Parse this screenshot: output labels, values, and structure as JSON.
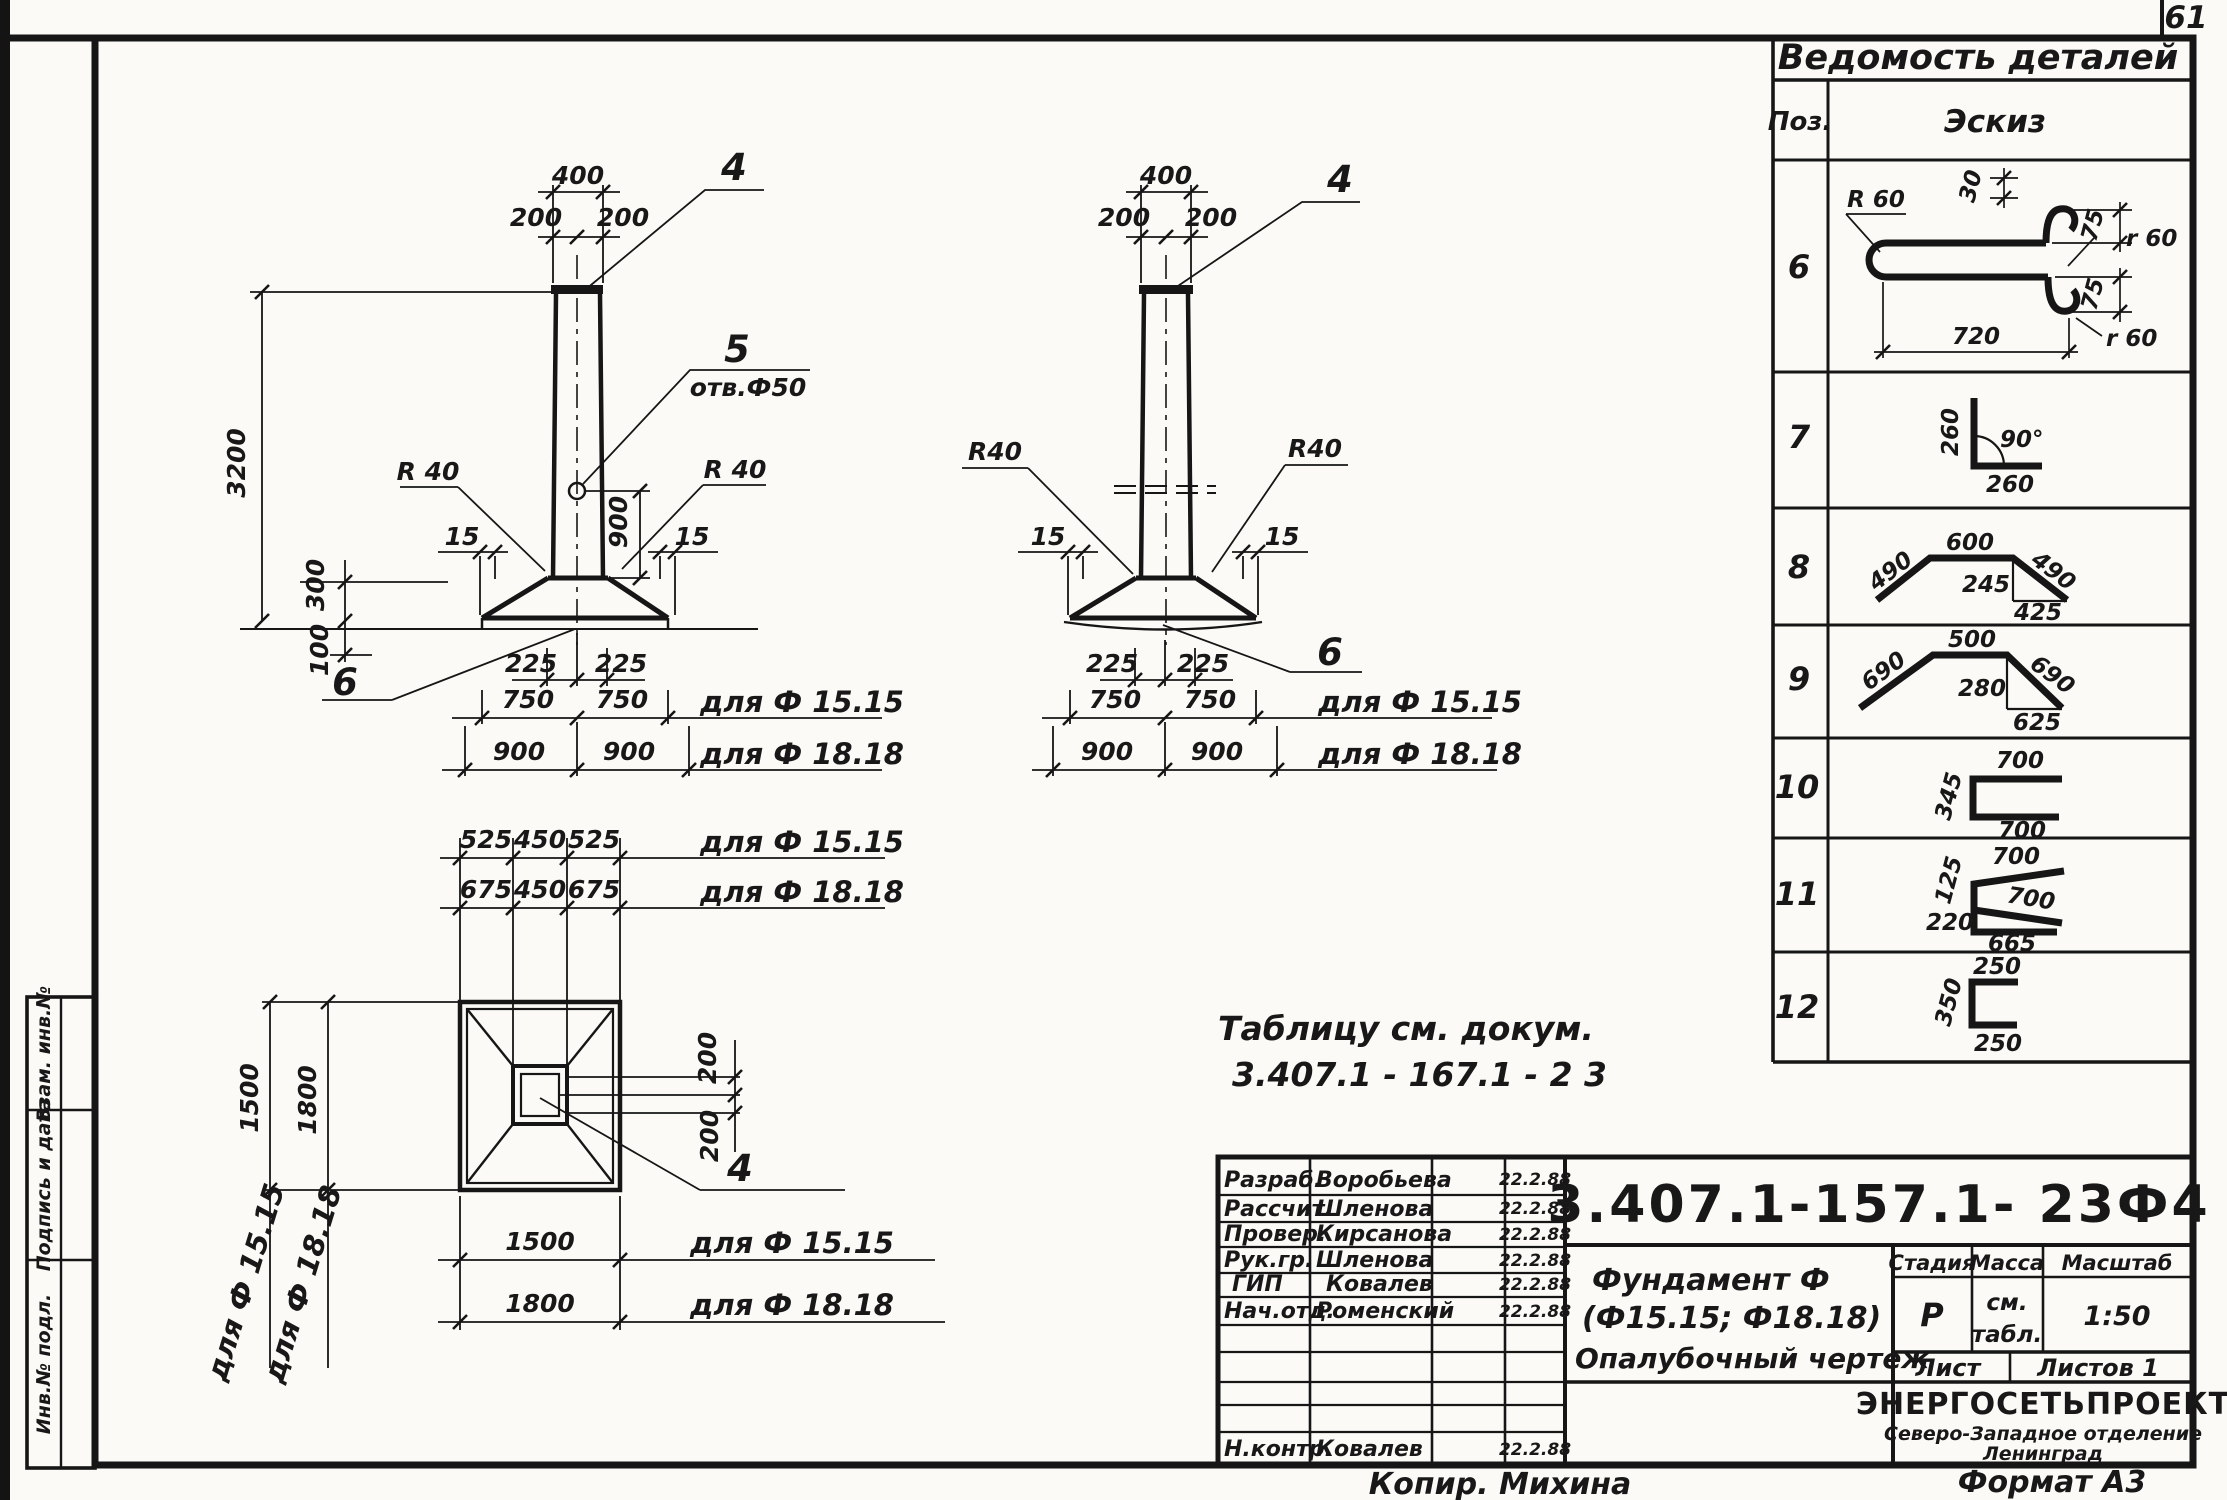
{
  "page_number": "61",
  "frame_stamps": {
    "top": "Взам. инв.№",
    "middle": "Подпись и дата",
    "bottom": "Инв.№ подл."
  },
  "views": {
    "front": {
      "dim_top_width": "400",
      "dim_top_left": "200",
      "dim_top_right": "200",
      "callout_top": "4",
      "callout_hole": "5",
      "hole_label": "отв.Ф50",
      "dim_height": "3200",
      "radius_left": "R 40",
      "radius_right": "R 40",
      "dim_off_left": "15",
      "dim_off_right": "15",
      "dim_300": "300",
      "dim_100": "100",
      "dim_900": "900",
      "dim_225_left": "225",
      "dim_225_right": "225",
      "callout_base": "6",
      "row_f15": {
        "a": "750",
        "b": "750",
        "label": "для Ф 15.15"
      },
      "row_f18": {
        "a": "900",
        "b": "900",
        "label": "для Ф 18.18"
      }
    },
    "side": {
      "dim_top_width": "400",
      "dim_top_left": "200",
      "dim_top_right": "200",
      "callout_top": "4",
      "radius_left": "R40",
      "radius_right": "R40",
      "dim_off_left": "15",
      "dim_off_right": "15",
      "dim_225_left": "225",
      "dim_225_right": "225",
      "callout_base": "6",
      "row_f15": {
        "a": "750",
        "b": "750",
        "label": "для Ф 15.15"
      },
      "row_f18": {
        "a": "900",
        "b": "900",
        "label": "для Ф 18.18"
      }
    },
    "plan": {
      "row_f15": {
        "a": "525",
        "b": "450",
        "c": "525",
        "label": "для Ф 15.15"
      },
      "row_f18": {
        "a": "675",
        "b": "450",
        "c": "675",
        "label": "для Ф 18.18"
      },
      "dim_1500": "1500",
      "dim_1800": "1800",
      "rot_label_f15": "для Ф 15.15",
      "rot_label_f18": "для Ф 18.18",
      "dim_200_top": "200",
      "dim_200_bottom": "200",
      "callout": "4",
      "bottom_f15": {
        "value": "1500",
        "label": "для Ф 15.15"
      },
      "bottom_f18": {
        "value": "1800",
        "label": "для Ф 18.18"
      }
    }
  },
  "note": {
    "line1": "Таблицу см. докум.",
    "line2": "3.407.1 - 167.1 -  2 3"
  },
  "parts_list": {
    "title": "Ведомость деталей",
    "col_pos": "Поз.",
    "col_sketch": "Эскиз",
    "rows": [
      {
        "pos": "6",
        "dims": {
          "radius": "R 60",
          "d30": "30",
          "d75_top": "75",
          "r60_top": "r 60",
          "d75_bottom": "75",
          "r60_bottom": "r 60",
          "length": "720"
        }
      },
      {
        "pos": "7",
        "dims": {
          "v": "260",
          "angle": "90°",
          "h": "260"
        }
      },
      {
        "pos": "8",
        "dims": {
          "left": "490",
          "top": "600",
          "right": "490",
          "height": "245",
          "base": "425"
        }
      },
      {
        "pos": "9",
        "dims": {
          "left": "690",
          "top": "500",
          "right": "690",
          "height": "280",
          "base": "625"
        }
      },
      {
        "pos": "10",
        "dims": {
          "top": "700",
          "height": "345",
          "bottom": "700"
        }
      },
      {
        "pos": "11",
        "dims": {
          "top": "700",
          "offset": "125",
          "middle": "700",
          "height": "220",
          "base": "665"
        }
      },
      {
        "pos": "12",
        "dims": {
          "top": "250",
          "height": "350",
          "bottom": "250"
        }
      }
    ]
  },
  "title_block": {
    "doc_number": "3.407.1-157.1-  23Ф4",
    "signature_rows": [
      {
        "role": "Разраб.",
        "name": "Воробьева",
        "date": "22.2.88"
      },
      {
        "role": "Рассчит.",
        "name": "Шленова",
        "date": "22.2.88"
      },
      {
        "role": "Провер.",
        "name": "Кирсанова",
        "date": "22.2.88"
      },
      {
        "role": "Рук.гр.",
        "name": "Шленова",
        "date": "22.2.88"
      },
      {
        "role": "ГИП",
        "name": "Ковалев",
        "date": "22.2.88"
      },
      {
        "role": "Нач.отд.",
        "name": "Роменский",
        "date": "22.2.88"
      }
    ],
    "ncontr": {
      "role": "Н.контр.",
      "name": "Ковалев",
      "date": "22.2.88"
    },
    "title_line1": "Фундамент Ф",
    "title_line2": "(Ф15.15;  Ф18.18)",
    "title_line3": "Опалубочный  чертеж",
    "stage_header": "Стадия",
    "mass_header": "Масса",
    "scale_header": "Масштаб",
    "stage": "Р",
    "mass_line1": "см.",
    "mass_line2": "табл.",
    "scale": "1:50",
    "sheet_label": "Лист",
    "sheets_label": "Листов 1",
    "org_line1": "ЭНЕРГОСЕТЬПРОЕКТ",
    "org_line2": "Северо-Западное отделение",
    "org_line3": "Ленинград"
  },
  "footer": {
    "copier": "Копир.  Михина",
    "format": "Формат А3"
  }
}
